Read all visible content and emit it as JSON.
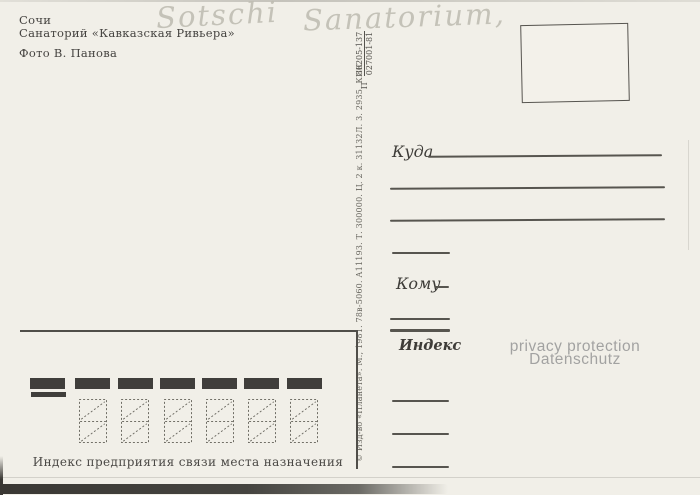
{
  "card": {
    "photo_credit": {
      "city": "Сочи",
      "title": "Санаторий «Кавказская Ривьера»",
      "photographer": "Фото В. Панова"
    },
    "handwriting": {
      "word1": "Sotschi",
      "word2": "Sanatorium,"
    },
    "imprint": {
      "index_prefix": "П",
      "index_numerator": "80205-137",
      "index_denominator": "027001-81",
      "publisher_line": "© Изд-во «Планета». М., 1981. 78в-5060. А11193. Т. 300000. Ц. 2 к. 31132Л. 3. 2935. КПК"
    },
    "address": {
      "kuda_label": "Куда",
      "komu_label": "Кому",
      "index_label": "Индекс"
    },
    "watermark": {
      "line1": "privacy protection",
      "line2": "Datenschutz"
    },
    "index_zone": {
      "caption": "Индекс предприятия связи места назначения",
      "bars": 7,
      "digit_boxes": 6
    },
    "colors": {
      "paper": "#f1efe8",
      "ink": "#454340",
      "bar": "#403e3b",
      "watermark": "#9c9c9c"
    }
  }
}
